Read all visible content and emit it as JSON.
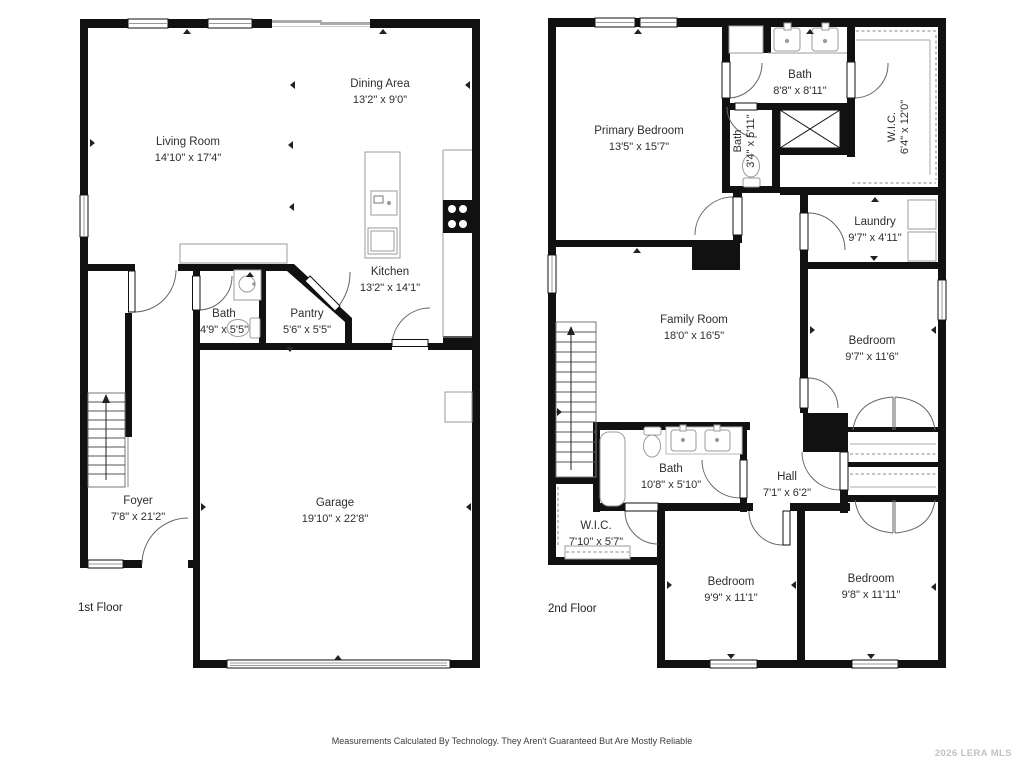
{
  "floor1": {
    "label": "1st Floor",
    "rooms": {
      "living": {
        "name": "Living Room",
        "dims": "14'10\" x 17'4\""
      },
      "dining": {
        "name": "Dining Area",
        "dims": "13'2\" x 9'0\""
      },
      "kitchen": {
        "name": "Kitchen",
        "dims": "13'2\" x 14'1\""
      },
      "bath": {
        "name": "Bath",
        "dims": "4'9\" x 5'5\""
      },
      "pantry": {
        "name": "Pantry",
        "dims": "5'6\" x 5'5\""
      },
      "foyer": {
        "name": "Foyer",
        "dims": "7'8\" x 21'2\""
      },
      "garage": {
        "name": "Garage",
        "dims": "19'10\" x 22'8\""
      }
    }
  },
  "floor2": {
    "label": "2nd Floor",
    "rooms": {
      "primary_bedroom": {
        "name": "Primary Bedroom",
        "dims": "13'5\" x 15'7\""
      },
      "bath_main": {
        "name": "Bath",
        "dims": "8'8\" x 8'11\""
      },
      "bath_small": {
        "name": "Bath",
        "dims": "3'4\" x 5'11\""
      },
      "wic_top": {
        "name": "W.I.C.",
        "dims": "6'4\" x 12'0\""
      },
      "laundry": {
        "name": "Laundry",
        "dims": "9'7\" x 4'11\""
      },
      "family_room": {
        "name": "Family Room",
        "dims": "18'0\" x 16'5\""
      },
      "bedroom_right": {
        "name": "Bedroom",
        "dims": "9'7\" x 11'6\""
      },
      "bath_hall": {
        "name": "Bath",
        "dims": "10'8\" x 5'10\""
      },
      "hall": {
        "name": "Hall",
        "dims": "7'1\" x 6'2\""
      },
      "wic_bottom": {
        "name": "W.I.C.",
        "dims": "7'10\" x 5'7\""
      },
      "bedroom_bl": {
        "name": "Bedroom",
        "dims": "9'9\" x 11'1\""
      },
      "bedroom_br": {
        "name": "Bedroom",
        "dims": "9'8\" x 11'11\""
      }
    }
  },
  "footer": {
    "disclaimer": "Measurements Calculated By Technology. They Aren't Guaranteed But Are Mostly Reliable",
    "watermark": "2026 LERA MLS"
  },
  "colors": {
    "wall": "#111111",
    "fixture": "#9b9b9b",
    "label": "#2e2e2e"
  }
}
